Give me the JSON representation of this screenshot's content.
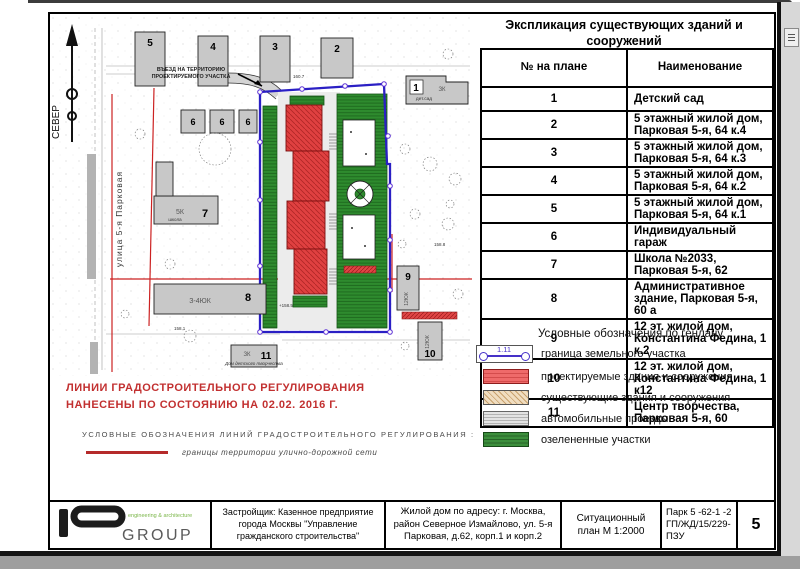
{
  "explication": {
    "title": "Экспликация существующих зданий и сооружений",
    "col_num": "№ на плане",
    "col_name": "Наименование",
    "rows": [
      {
        "num": "1",
        "name": "Детский сад"
      },
      {
        "num": "2",
        "name": "5 этажный жилой дом, Парковая 5-я, 64 к.4"
      },
      {
        "num": "3",
        "name": "5 этажный жилой дом, Парковая 5-я, 64 к.3"
      },
      {
        "num": "4",
        "name": "5 этажный жилой дом, Парковая 5-я, 64 к.2"
      },
      {
        "num": "5",
        "name": "5 этажный жилой дом, Парковая 5-я, 64 к.1"
      },
      {
        "num": "6",
        "name": "Индивидуальный гараж"
      },
      {
        "num": "7",
        "name": "Школа №2033, Парковая 5-я, 62"
      },
      {
        "num": "8",
        "name": "Административное здание, Парковая 5-я, 60 а"
      },
      {
        "num": "9",
        "name": "12 эт. жилой дом, Константина Федина, 1 к.2"
      },
      {
        "num": "10",
        "name": "12 эт. жилой дом, Константина Федина, 1 к12"
      },
      {
        "num": "11",
        "name": "Центр творчества, Парковая 5-я, 60"
      }
    ]
  },
  "legend": {
    "title": "Условные обозначения по генлану",
    "boundary_tag": "1.11",
    "items": [
      {
        "label": "граница земельного участка"
      },
      {
        "label": "проектируемые здания и сооружения"
      },
      {
        "label": "существующие здания и сооружения"
      },
      {
        "label": "автомобильные проезды"
      },
      {
        "label": "озелененные участки"
      }
    ]
  },
  "regulation": {
    "line1": "ЛИНИИ ГРАДОСТРОИТЕЛЬНОГО РЕГУЛИРОВАНИЯ",
    "line2": "НАНЕСЕНЫ ПО СОСТОЯНИЮ НА 02.02. 2016 Г.",
    "subtitle": "УСЛОВНЫЕ ОБОЗНАЧЕНИЯ ЛИНИЙ ГРАДОСТРОИТЕЛЬНОГО РЕГУЛИРОВАНИЯ :",
    "item": "границы территории улично-дорожной сети"
  },
  "map": {
    "north": "СЕВЕР",
    "street": "улица 5-я Парковая",
    "entrance_line1": "ВЪЕЗД НА ТЕРРИТОРИЮ",
    "entrance_line2": "ПРОЕКТИРУЕМОГО УЧАСТКА",
    "buildings": {
      "b1": {
        "num": "1",
        "code": "ЗК",
        "note": "дет.сад"
      },
      "b2": {
        "num": "2"
      },
      "b3": {
        "num": "3"
      },
      "b4": {
        "num": "4"
      },
      "b5": {
        "num": "5"
      },
      "b6": {
        "num": "6"
      },
      "b7": {
        "num": "7",
        "code": "5К",
        "note": "школа"
      },
      "b8": {
        "num": "8",
        "code": "З-4ЮК"
      },
      "b9": {
        "num": "9",
        "code": "12ЮК"
      },
      "b10": {
        "num": "10",
        "code": "12ЮК"
      },
      "b11": {
        "num": "11",
        "code": "ЗК",
        "note": "Дом детского творчества"
      }
    },
    "elevations": [
      "160.7",
      "158.1",
      "+158.5",
      "158.8"
    ]
  },
  "titleblock": {
    "logo_group": "GROUP",
    "logo_tagline": "engineering & architecture",
    "developer": "Застройщик: Казенное предприятие города Москвы \"Управление гражданского строительства\"",
    "project": "Жилой дом по адресу: г. Москва,  район Северное Измайлово, ул. 5-я Парковая, д.62, корп.1 и  корп.2",
    "doc_type": "Ситуационный план М 1:2000",
    "doc_code": "Парк 5 -62-1 -2  ГП/ЖД/15/229-ПЗУ",
    "sheet": "5"
  },
  "colors": {
    "boundary": "#2a1fc4",
    "proposed": "#e04040",
    "existing_hatch": "#e6d0a8",
    "roads": "#cfcfcf",
    "greenery": "#2e8b2e",
    "regulation_red": "#c23030",
    "logo_green": "#7ab648"
  }
}
